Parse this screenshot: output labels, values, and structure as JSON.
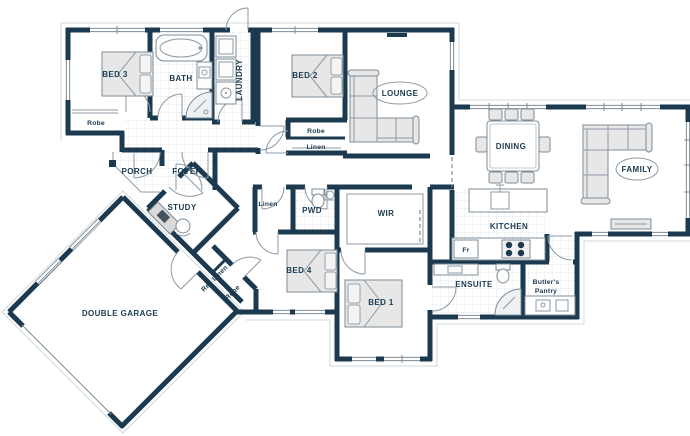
{
  "plan": {
    "type": "floor-plan",
    "title": "Single storey house floor plan with double garage",
    "colors": {
      "wall": "#1b3a4f",
      "label_text": "#1b3a4f",
      "furniture_fill": "#e7e7e7",
      "tile_line": "#d8dee2",
      "background": "#ffffff"
    },
    "rooms": {
      "bed3": "BED 3",
      "bath": "BATH",
      "laundry": "LAUNDRY",
      "bed2": "BED 2",
      "lounge": "LOUNGE",
      "dining": "DINING",
      "family": "FAMILY",
      "kitchen": "KITCHEN",
      "porch": "PORCH",
      "foyer": "FOYER",
      "study": "STUDY",
      "garage": "DOUBLE GARAGE",
      "wir": "WIR",
      "pwd": "PWD",
      "bed4": "BED 4",
      "bed1": "BED 1",
      "ensuite": "ENSUITE",
      "butlers_pantry_line1": "Butler's",
      "butlers_pantry_line2": "Pantry"
    },
    "storage": {
      "robe_bed3": "Robe",
      "robe_bed2": "Robe",
      "linen_bed2": "Linen",
      "linen_hall": "Linen",
      "rec_linen": "Rec Linen",
      "robe_hall": "Robe"
    },
    "appliances": {
      "fridge": "Fr"
    }
  }
}
